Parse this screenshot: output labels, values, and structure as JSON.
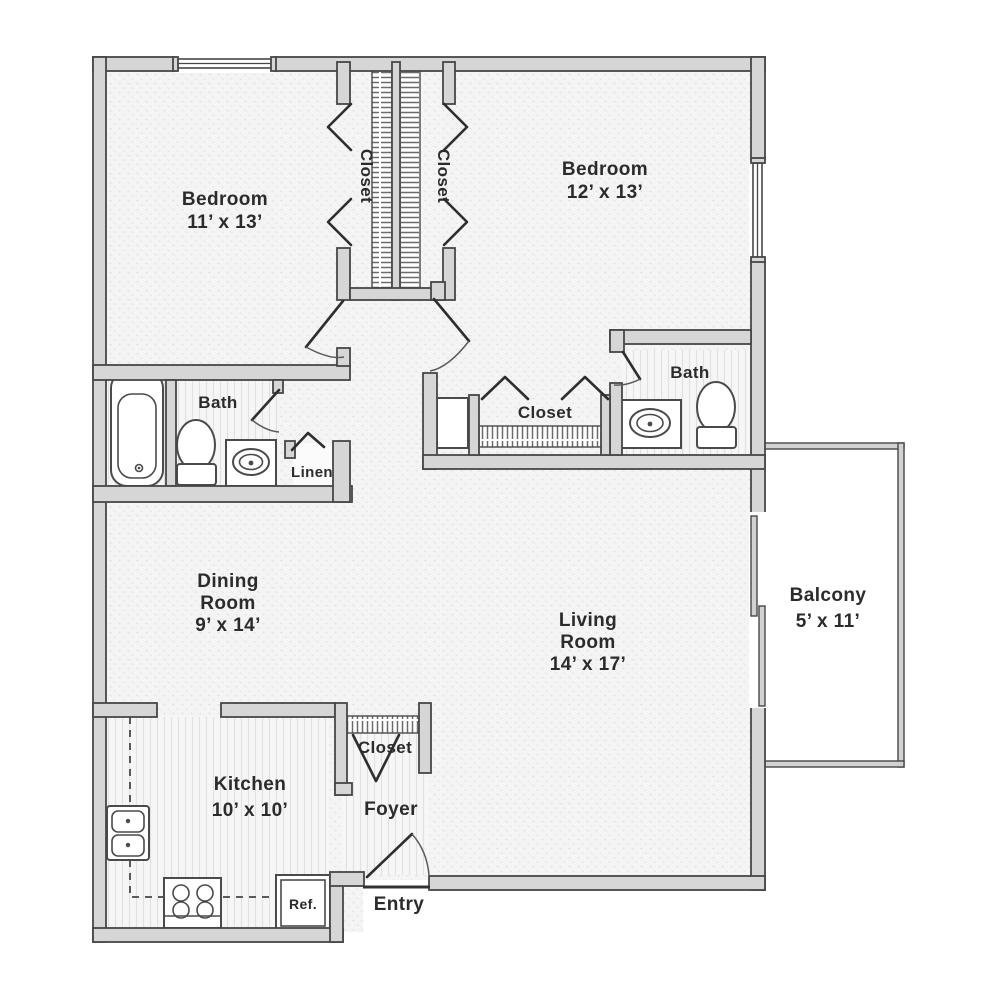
{
  "plan": {
    "title": "Two bedroom apartment floor plan",
    "labels": {
      "bedroom1_name": "Bedroom",
      "bedroom1_dims": "11’ x 13’",
      "bedroom2_name": "Bedroom",
      "bedroom2_dims": "12’ x 13’",
      "closet_left": "Closet",
      "closet_right": "Closet",
      "bath_left": "Bath",
      "bath_right": "Bath",
      "linen": "Linen",
      "hall_closet": "Closet",
      "dining_line1": "Dining",
      "dining_line2": "Room",
      "dining_dims": "9’ x 14’",
      "living_line1": "Living",
      "living_line2": "Room",
      "living_dims": "14’ x 17’",
      "balcony_name": "Balcony",
      "balcony_dims": "5’ x 11’",
      "kitchen_name": "Kitchen",
      "kitchen_dims": "10’ x 10’",
      "foyer_closet": "Closet",
      "foyer": "Foyer",
      "entry": "Entry",
      "refrigerator": "Ref."
    },
    "colors": {
      "wall_fill": "#d6d6d6",
      "wall_stroke": "#474747",
      "label_text": "#2b2b2b",
      "floor_dotted": "#f4f4f4",
      "floor_striped": "#f6f6f6",
      "background": "#ffffff"
    }
  }
}
